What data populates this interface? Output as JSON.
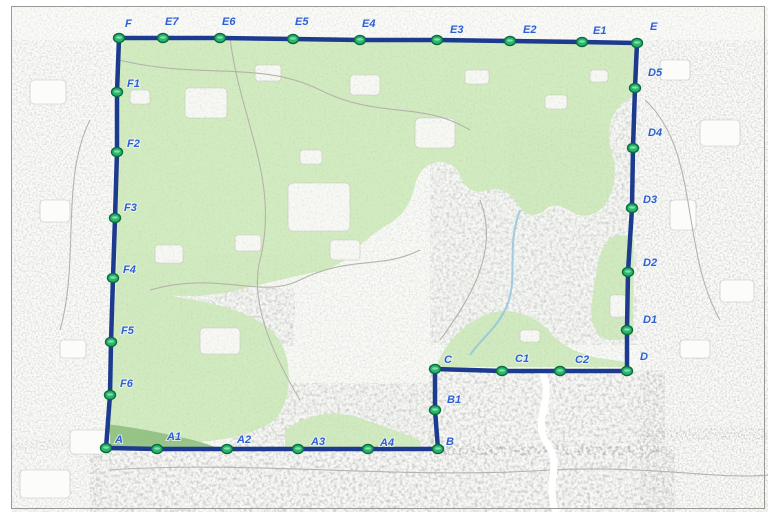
{
  "map": {
    "kind": "cadastral-boundary-map",
    "colors": {
      "boundary_line": "#1c3a8e",
      "marker_fill": "#2cb56c",
      "marker_stroke": "#0a6b3e",
      "marker_highlight": "#8fe6b8",
      "point_label": "#2f5fd0",
      "green_area": "#cfe9bc",
      "dark_green_area": "#8fbf80",
      "paper": "#fbfbf8",
      "frame": "#9a9a94"
    },
    "boundary": {
      "closed": true,
      "points": [
        {
          "id": "F",
          "x": 119,
          "y": 38,
          "lx": 6,
          "ly": -11
        },
        {
          "id": "E7",
          "x": 163,
          "y": 38,
          "lx": 2,
          "ly": -13
        },
        {
          "id": "E6",
          "x": 220,
          "y": 38,
          "lx": 2,
          "ly": -13
        },
        {
          "id": "E5",
          "x": 293,
          "y": 39,
          "lx": 2,
          "ly": -14
        },
        {
          "id": "E4",
          "x": 360,
          "y": 40,
          "lx": 2,
          "ly": -13
        },
        {
          "id": "E3",
          "x": 437,
          "y": 40,
          "lx": 13,
          "ly": -7
        },
        {
          "id": "E2",
          "x": 510,
          "y": 41,
          "lx": 13,
          "ly": -8
        },
        {
          "id": "E1",
          "x": 582,
          "y": 42,
          "lx": 11,
          "ly": -8
        },
        {
          "id": "E",
          "x": 637,
          "y": 43,
          "lx": 13,
          "ly": -13
        },
        {
          "id": "D5",
          "x": 635,
          "y": 88,
          "lx": 13,
          "ly": -12
        },
        {
          "id": "D4",
          "x": 633,
          "y": 148,
          "lx": 15,
          "ly": -12
        },
        {
          "id": "D3",
          "x": 632,
          "y": 208,
          "lx": 11,
          "ly": -5
        },
        {
          "id": "D2",
          "x": 628,
          "y": 272,
          "lx": 15,
          "ly": -6
        },
        {
          "id": "D1",
          "x": 627,
          "y": 330,
          "lx": 16,
          "ly": -7
        },
        {
          "id": "D",
          "x": 627,
          "y": 371,
          "lx": 13,
          "ly": -11
        },
        {
          "id": "C2",
          "x": 560,
          "y": 371,
          "lx": 15,
          "ly": -8
        },
        {
          "id": "C1",
          "x": 502,
          "y": 371,
          "lx": 13,
          "ly": -9
        },
        {
          "id": "C",
          "x": 435,
          "y": 369,
          "lx": 9,
          "ly": -6
        },
        {
          "id": "B1",
          "x": 435,
          "y": 410,
          "lx": 12,
          "ly": -7
        },
        {
          "id": "B",
          "x": 438,
          "y": 449,
          "lx": 8,
          "ly": -4
        },
        {
          "id": "A4",
          "x": 368,
          "y": 449,
          "lx": 12,
          "ly": -3
        },
        {
          "id": "A3",
          "x": 298,
          "y": 449,
          "lx": 13,
          "ly": -4
        },
        {
          "id": "A2",
          "x": 227,
          "y": 449,
          "lx": 10,
          "ly": -6
        },
        {
          "id": "A1",
          "x": 157,
          "y": 449,
          "lx": 10,
          "ly": -9
        },
        {
          "id": "A",
          "x": 106,
          "y": 448,
          "lx": 9,
          "ly": -5
        },
        {
          "id": "F6",
          "x": 110,
          "y": 395,
          "lx": 10,
          "ly": -8
        },
        {
          "id": "F5",
          "x": 111,
          "y": 342,
          "lx": 10,
          "ly": -8
        },
        {
          "id": "F4",
          "x": 113,
          "y": 278,
          "lx": 10,
          "ly": -5
        },
        {
          "id": "F3",
          "x": 115,
          "y": 218,
          "lx": 9,
          "ly": -7
        },
        {
          "id": "F2",
          "x": 117,
          "y": 152,
          "lx": 10,
          "ly": -5
        },
        {
          "id": "F1",
          "x": 117,
          "y": 92,
          "lx": 10,
          "ly": -5
        }
      ]
    }
  }
}
